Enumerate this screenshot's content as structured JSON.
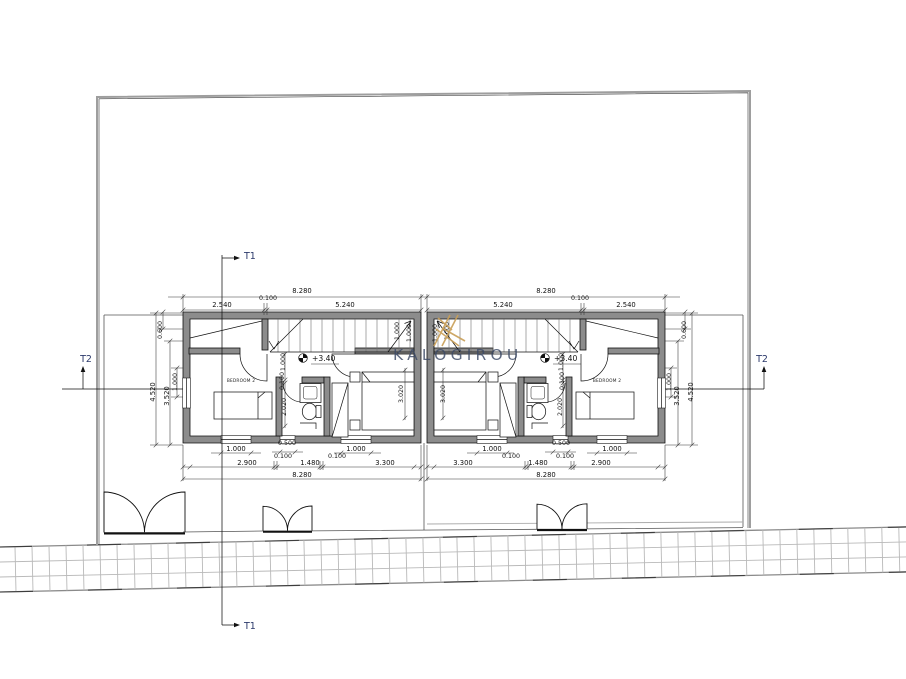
{
  "watermark": {
    "text": "KALOGIROU"
  },
  "markers": {
    "t1": "T1",
    "t2": "T2"
  },
  "left_unit": {
    "room_label": "BEDROOM 2",
    "level_mark": "+3.40",
    "top_total": "8.280",
    "top_segs": [
      "2.540",
      "0.100",
      "5.240"
    ],
    "window_widths": [
      "1.000",
      "0.500",
      "1.000"
    ],
    "bottom_segs": [
      "2.900",
      "0.100",
      "1.480",
      "0.100",
      "3.300"
    ],
    "bottom_total": "8.280",
    "side_dims": [
      "0.600",
      "4.520",
      "3.520",
      "1.000"
    ],
    "interior_dims": [
      "1.000",
      "0.100",
      "2.020",
      "3.020",
      "1.000",
      "1.000"
    ]
  },
  "right_unit": {
    "room_label": "BEDROOM 2",
    "level_mark": "+3.40",
    "top_total": "8.280",
    "top_segs": [
      "5.240",
      "0.100",
      "2.540"
    ],
    "window_widths": [
      "1.000",
      "0.500",
      "1.000"
    ],
    "bottom_segs": [
      "3.300",
      "0.100",
      "1.480",
      "0.100",
      "2.900"
    ],
    "bottom_total": "8.280",
    "side_dims": [
      "0.600",
      "4.520",
      "3.520",
      "1.000"
    ],
    "interior_dims": [
      "1.000",
      "0.100",
      "2.020",
      "3.020",
      "1.000",
      "1.000"
    ]
  },
  "colors": {
    "wall_fill": "#8c8c8c",
    "watermark_text": "#3c4a66",
    "watermark_logo": "#c99f57",
    "section_label": "#2c3a6b"
  }
}
